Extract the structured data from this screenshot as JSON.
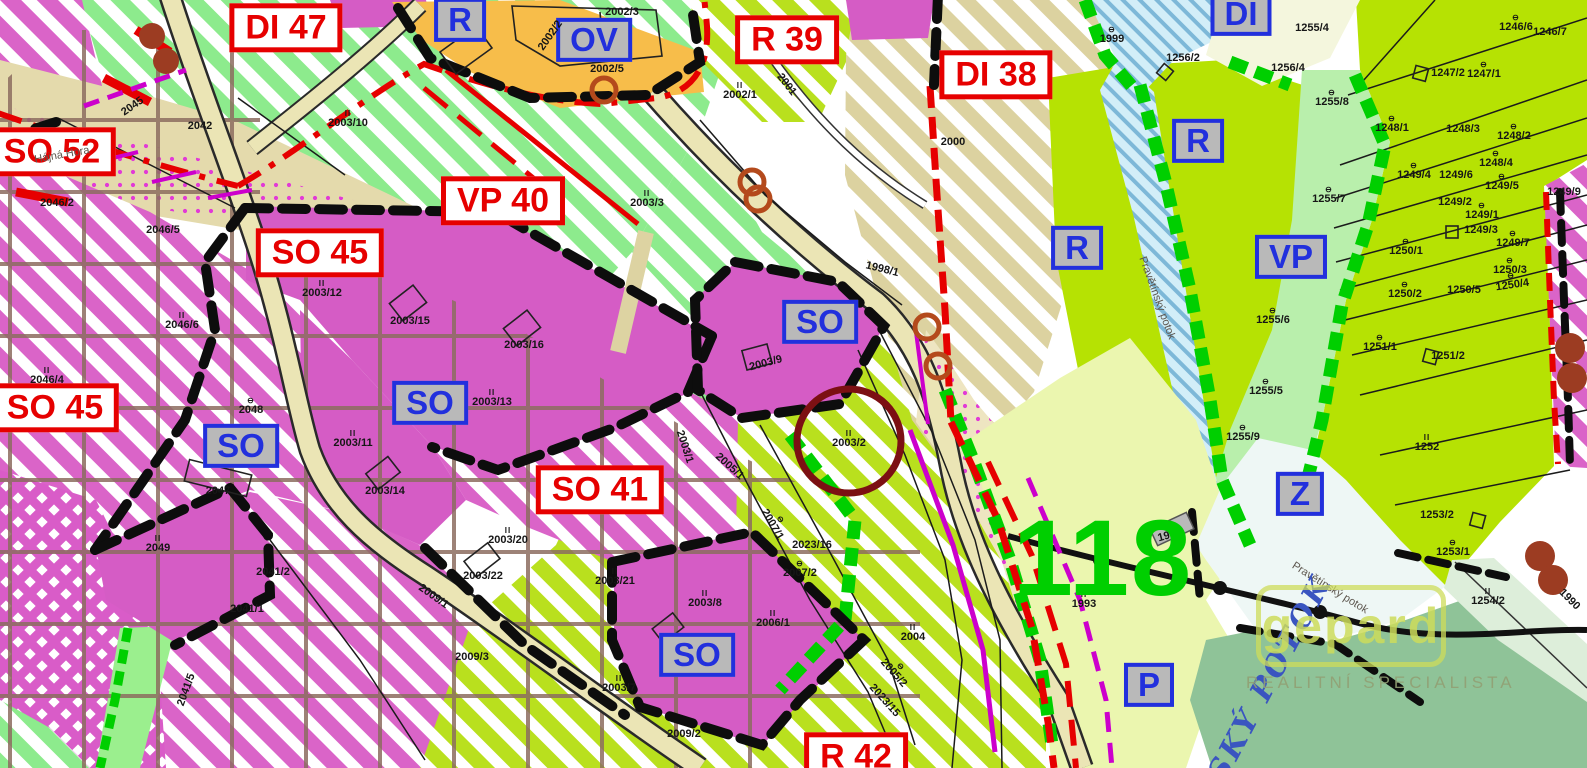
{
  "colors": {
    "accent_red": "#e60000",
    "accent_blue": "#2230dd",
    "magenta": "#d55cc5",
    "chartreuse": "#b6e203",
    "bright_green": "#00cf00",
    "highlight_ring": "#7c1013",
    "orange": "#f7bd4a"
  },
  "zones_red": [
    {
      "label": "SO 52",
      "x": 52,
      "y": 152
    },
    {
      "label": "DI 47",
      "x": 286,
      "y": 28
    },
    {
      "label": "R 39",
      "x": 787,
      "y": 40
    },
    {
      "label": "DI 38",
      "x": 996,
      "y": 75
    },
    {
      "label": "VP 40",
      "x": 503,
      "y": 201
    },
    {
      "label": "SO 45",
      "x": 320,
      "y": 253
    },
    {
      "label": "SO 45",
      "x": 55,
      "y": 408
    },
    {
      "label": "SO 41",
      "x": 600,
      "y": 490
    },
    {
      "label": "R 42",
      "x": 856,
      "y": 757
    }
  ],
  "zones_blue": [
    {
      "label": "R",
      "x": 460,
      "y": 20
    },
    {
      "label": "OV",
      "x": 594,
      "y": 40
    },
    {
      "label": "DI",
      "x": 1241,
      "y": 14
    },
    {
      "label": "R",
      "x": 1198,
      "y": 141
    },
    {
      "label": "R",
      "x": 1077,
      "y": 248
    },
    {
      "label": "VP",
      "x": 1291,
      "y": 257
    },
    {
      "label": "Z",
      "x": 1300,
      "y": 494
    },
    {
      "label": "P",
      "x": 1149,
      "y": 685
    },
    {
      "label": "SO",
      "x": 241,
      "y": 446
    },
    {
      "label": "SO",
      "x": 430,
      "y": 403
    },
    {
      "label": "SO",
      "x": 820,
      "y": 322
    },
    {
      "label": "SO",
      "x": 697,
      "y": 655
    }
  ],
  "parcels": [
    {
      "n": "2045",
      "x": 133,
      "y": 107,
      "r": -35
    },
    {
      "n": "2042",
      "x": 200,
      "y": 127
    },
    {
      "n": "2046/2",
      "x": 57,
      "y": 204
    },
    {
      "n": "2046/5",
      "x": 163,
      "y": 231
    },
    {
      "n": "2003/10",
      "x": 348,
      "y": 120,
      "g": "II"
    },
    {
      "n": "2046/6",
      "x": 182,
      "y": 322,
      "g": "II"
    },
    {
      "n": "2046/4",
      "x": 47,
      "y": 377,
      "g": "II"
    },
    {
      "n": "2048",
      "x": 251,
      "y": 407,
      "g": "⊖"
    },
    {
      "n": "2047",
      "x": 218,
      "y": 492
    },
    {
      "n": "2049",
      "x": 158,
      "y": 545,
      "g": "II"
    },
    {
      "n": "2041/2",
      "x": 273,
      "y": 573
    },
    {
      "n": "2041/1",
      "x": 247,
      "y": 610
    },
    {
      "n": "2041/5",
      "x": 187,
      "y": 690,
      "r": -70
    },
    {
      "n": "2009/1",
      "x": 433,
      "y": 597,
      "r": 35
    },
    {
      "n": "2009/3",
      "x": 472,
      "y": 658
    },
    {
      "n": "2009/2",
      "x": 684,
      "y": 735
    },
    {
      "n": "2003/12",
      "x": 322,
      "y": 290,
      "g": "II"
    },
    {
      "n": "2003/15",
      "x": 410,
      "y": 322
    },
    {
      "n": "2003/16",
      "x": 524,
      "y": 346
    },
    {
      "n": "2003/13",
      "x": 492,
      "y": 399,
      "g": "II"
    },
    {
      "n": "2003/11",
      "x": 353,
      "y": 440,
      "g": "II"
    },
    {
      "n": "2003/14",
      "x": 385,
      "y": 492
    },
    {
      "n": "2003/20",
      "x": 508,
      "y": 537,
      "g": "II"
    },
    {
      "n": "2003/22",
      "x": 483,
      "y": 577
    },
    {
      "n": "2003/21",
      "x": 615,
      "y": 578,
      "g": "II"
    },
    {
      "n": "2003/8",
      "x": 705,
      "y": 600,
      "g": "II"
    },
    {
      "n": "2003/7",
      "x": 619,
      "y": 685,
      "g": "II"
    },
    {
      "n": "2006/1",
      "x": 773,
      "y": 620,
      "g": "II"
    },
    {
      "n": "2005/1",
      "x": 729,
      "y": 467,
      "r": 42
    },
    {
      "n": "2003/1",
      "x": 684,
      "y": 447,
      "r": 72
    },
    {
      "n": "2007/1",
      "x": 775,
      "y": 523,
      "r": 60,
      "g": "⊖"
    },
    {
      "n": "2007/2",
      "x": 800,
      "y": 570,
      "g": "⊖"
    },
    {
      "n": "2023/16",
      "x": 812,
      "y": 546
    },
    {
      "n": "2023/15",
      "x": 884,
      "y": 701,
      "r": 48
    },
    {
      "n": "2004",
      "x": 913,
      "y": 634,
      "g": "II"
    },
    {
      "n": "2005/2",
      "x": 896,
      "y": 671,
      "r": 48,
      "g": "⊖"
    },
    {
      "n": "2003/2",
      "x": 849,
      "y": 440,
      "g": "II"
    },
    {
      "n": "2003/9",
      "x": 766,
      "y": 364,
      "r": -15
    },
    {
      "n": "1998/1",
      "x": 882,
      "y": 270,
      "r": 14
    },
    {
      "n": "2002/5",
      "x": 607,
      "y": 70
    },
    {
      "n": "2002/2",
      "x": 551,
      "y": 36,
      "r": -55
    },
    {
      "n": "2002/3",
      "x": 622,
      "y": 13
    },
    {
      "n": "2002/1",
      "x": 740,
      "y": 92,
      "g": "II"
    },
    {
      "n": "2001",
      "x": 786,
      "y": 85,
      "r": 52
    },
    {
      "n": "2003/3",
      "x": 647,
      "y": 200,
      "g": "II"
    },
    {
      "n": "2000",
      "x": 953,
      "y": 143
    },
    {
      "n": "1999",
      "x": 1112,
      "y": 36,
      "g": "⊖"
    },
    {
      "n": "1256/2",
      "x": 1183,
      "y": 59
    },
    {
      "n": "1255/4",
      "x": 1312,
      "y": 29
    },
    {
      "n": "1256/4",
      "x": 1288,
      "y": 69
    },
    {
      "n": "1255/8",
      "x": 1332,
      "y": 99,
      "g": "⊖"
    },
    {
      "n": "1248/1",
      "x": 1392,
      "y": 125,
      "g": "⊖"
    },
    {
      "n": "1246/6",
      "x": 1516,
      "y": 24,
      "g": "⊖"
    },
    {
      "n": "1246/7",
      "x": 1550,
      "y": 33
    },
    {
      "n": "1247/2",
      "x": 1448,
      "y": 74
    },
    {
      "n": "1247/1",
      "x": 1484,
      "y": 71,
      "g": "⊖"
    },
    {
      "n": "1248/3",
      "x": 1463,
      "y": 130
    },
    {
      "n": "1248/2",
      "x": 1514,
      "y": 133,
      "g": "⊖"
    },
    {
      "n": "1248/4",
      "x": 1496,
      "y": 160,
      "g": "⊖"
    },
    {
      "n": "1249/4",
      "x": 1414,
      "y": 172,
      "g": "⊖"
    },
    {
      "n": "1249/6",
      "x": 1456,
      "y": 176
    },
    {
      "n": "1249/5",
      "x": 1502,
      "y": 183,
      "g": "⊖"
    },
    {
      "n": "1249/9",
      "x": 1564,
      "y": 193
    },
    {
      "n": "1249/2",
      "x": 1455,
      "y": 203
    },
    {
      "n": "1249/1",
      "x": 1482,
      "y": 212,
      "g": "⊖"
    },
    {
      "n": "1249/3",
      "x": 1481,
      "y": 231
    },
    {
      "n": "1249/7",
      "x": 1513,
      "y": 240,
      "g": "⊖"
    },
    {
      "n": "1255/7",
      "x": 1329,
      "y": 196,
      "g": "⊖"
    },
    {
      "n": "1250/1",
      "x": 1406,
      "y": 248,
      "g": "⊖"
    },
    {
      "n": "1250/3",
      "x": 1510,
      "y": 267,
      "g": "⊖"
    },
    {
      "n": "1250/2",
      "x": 1405,
      "y": 291,
      "g": "⊖"
    },
    {
      "n": "1250/5",
      "x": 1464,
      "y": 291
    },
    {
      "n": "1250/4",
      "x": 1512,
      "y": 282,
      "g": "⊖",
      "r": -8
    },
    {
      "n": "1255/6",
      "x": 1273,
      "y": 317,
      "g": "⊖"
    },
    {
      "n": "1251/1",
      "x": 1380,
      "y": 344,
      "g": "⊖"
    },
    {
      "n": "1251/2",
      "x": 1448,
      "y": 357
    },
    {
      "n": "1255/5",
      "x": 1266,
      "y": 388,
      "g": "⊖"
    },
    {
      "n": "1255/9",
      "x": 1243,
      "y": 434,
      "g": "⊖"
    },
    {
      "n": "1252",
      "x": 1427,
      "y": 444,
      "g": "II"
    },
    {
      "n": "1253/2",
      "x": 1437,
      "y": 516
    },
    {
      "n": "1253/1",
      "x": 1453,
      "y": 549,
      "g": "⊖"
    },
    {
      "n": "1254/2",
      "x": 1488,
      "y": 598,
      "g": "II"
    },
    {
      "n": "1990",
      "x": 1569,
      "y": 600,
      "r": 45
    },
    {
      "n": "1992",
      "x": 1170,
      "y": 536,
      "r": -15
    },
    {
      "n": "1993",
      "x": 1084,
      "y": 601,
      "g": "II"
    }
  ],
  "places": [
    {
      "n": "Hájná Hora",
      "x": 62,
      "y": 155,
      "r": -10
    },
    {
      "n": "Pravětínský potok",
      "x": 1330,
      "y": 588,
      "r": 32
    },
    {
      "n": "Pravětínský potok",
      "x": 1157,
      "y": 298,
      "r": 70
    }
  ],
  "stream_label": {
    "text": "SKÝ POTOK",
    "x": 1270,
    "y": 678
  },
  "area_number": {
    "text": "118",
    "x": 1103,
    "y": 558
  },
  "highlight": {
    "parcel": "2003/2",
    "x": 849,
    "y": 441
  },
  "watermark": {
    "name": "gepard",
    "tagline": "REALITNÍ SPECIALISTA"
  }
}
